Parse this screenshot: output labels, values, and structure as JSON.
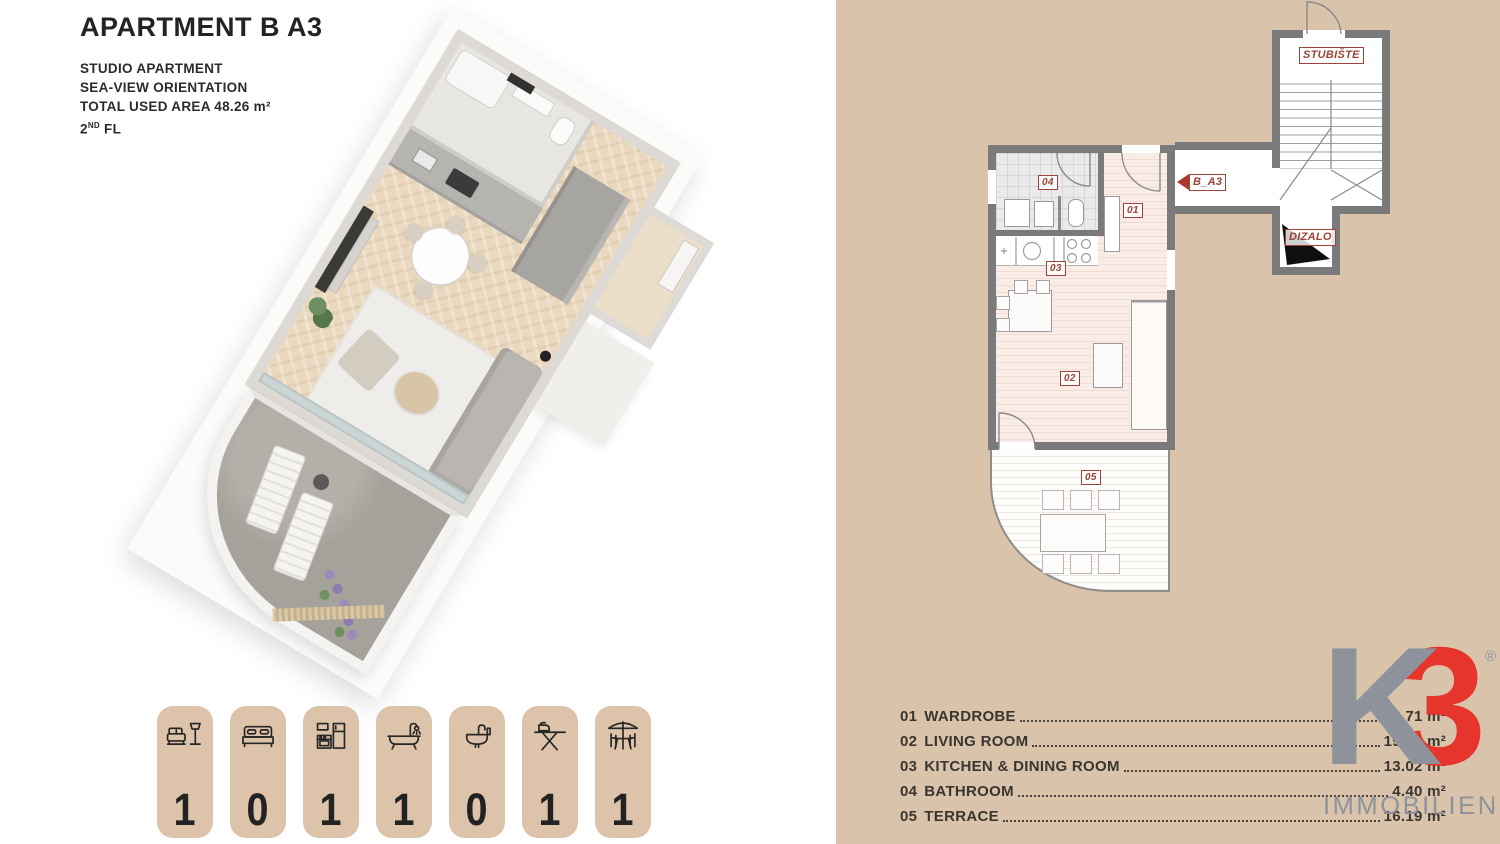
{
  "header": {
    "title": "APARTMENT B  A3",
    "line1": "STUDIO APARTMENT",
    "line2": "SEA-VIEW ORIENTATION",
    "area_line": "TOTAL USED AREA  48.26 m²",
    "floor_num": "2",
    "floor_sup": "ND",
    "floor_rest": " FL"
  },
  "amenities": {
    "items": [
      {
        "icon": "sofa-lamp-icon",
        "count": "1"
      },
      {
        "icon": "bed-icon",
        "count": "0"
      },
      {
        "icon": "kitchen-icon",
        "count": "1"
      },
      {
        "icon": "bathtub-icon",
        "count": "1"
      },
      {
        "icon": "washbasin-icon",
        "count": "0"
      },
      {
        "icon": "ironing-board-icon",
        "count": "1"
      },
      {
        "icon": "patio-icon",
        "count": "1"
      }
    ]
  },
  "plan": {
    "staircase": "STUBIŠTE",
    "elevator": "DIZALO",
    "unit": "B_A3",
    "markers": {
      "wardrobe": "01",
      "living": "02",
      "kitchen": "03",
      "bath": "04",
      "terrace": "05"
    }
  },
  "legend": {
    "rows": [
      {
        "num": "01",
        "name": "WARDROBE",
        "area": "3.71 m²"
      },
      {
        "num": "02",
        "name": "LIVING ROOM",
        "area": "19.04 m²"
      },
      {
        "num": "03",
        "name": "KITCHEN & DINING ROOM",
        "area": "13.02 m²"
      },
      {
        "num": "04",
        "name": "BATHROOM",
        "area": "4.40 m²"
      },
      {
        "num": "05",
        "name": "TERRACE",
        "area": "16.19 m²"
      }
    ]
  },
  "logo": {
    "letter": "K",
    "digit": "3",
    "reg": "®",
    "word": "IMMOBILIEN"
  },
  "colors": {
    "beige": "#d9c4ab",
    "wall_gray": "#7a7a7a",
    "label_brown": "#9c4437",
    "logo_gray": "#8e939b",
    "logo_red": "#e6352c"
  }
}
